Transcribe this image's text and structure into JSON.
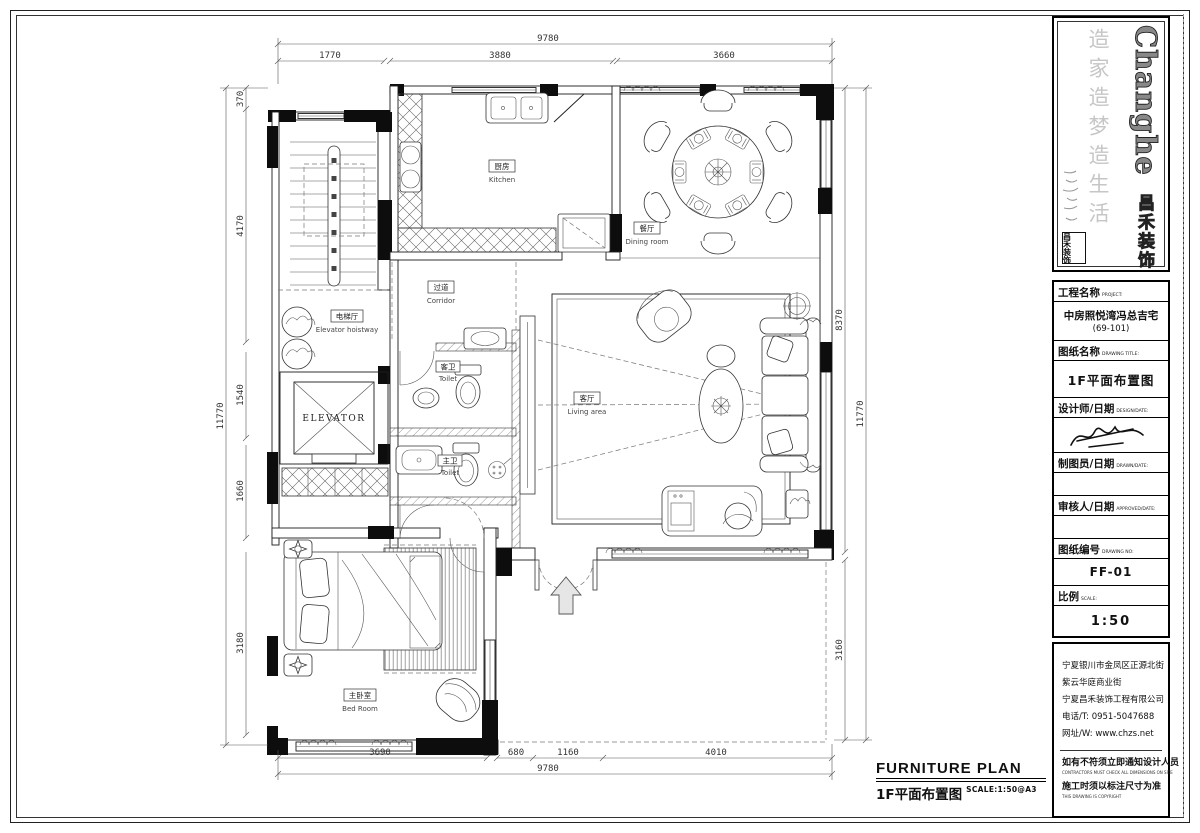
{
  "plan": {
    "rooms": {
      "kitchen": {
        "cn": "厨房",
        "en": "Kitchen"
      },
      "dining": {
        "cn": "餐厅",
        "en": "Dining room"
      },
      "corridor": {
        "cn": "过道",
        "en": "Corridor"
      },
      "elevator_hall": {
        "cn": "电梯厅",
        "en": "Elevator hoistway"
      },
      "elevator": {
        "label": "ELEVATOR"
      },
      "guest_toilet": {
        "cn": "客卫",
        "en": "Toilet"
      },
      "master_toilet": {
        "cn": "主卫",
        "en": "Toilet"
      },
      "living": {
        "cn": "客厅",
        "en": "Living area"
      },
      "bedroom": {
        "cn": "主卧室",
        "en": "Bed Room"
      }
    },
    "dims": {
      "top": {
        "overall": "9780",
        "segs": [
          "1770",
          "3880",
          "3660"
        ]
      },
      "bottom": {
        "overall": "9780",
        "segs": [
          "3690",
          "680",
          "1160",
          "4010"
        ]
      },
      "left": {
        "overall": "11770",
        "segs": [
          "370",
          "4170",
          "1540",
          "1660",
          "3180"
        ]
      },
      "right": {
        "overall": "11770",
        "segs": [
          "8370",
          "3160"
        ]
      }
    }
  },
  "footer": {
    "title_en": "FURNITURE PLAN",
    "title_cn": "1F平面布置图",
    "scale": "SCALE:1:50@A3"
  },
  "titleblock": {
    "logo": {
      "en": "Changhe",
      "cn": "昌禾装饰",
      "slogan": "造家造梦造生活",
      "seal": "昌禾装饰"
    },
    "project": {
      "label_cn": "工程名称",
      "label_en": "PROJECT:",
      "value": "中房照悦湾冯总吉宅",
      "value2": "(69-101)"
    },
    "drawing_title": {
      "label_cn": "图纸名称",
      "label_en": "DRAWING TITLE:",
      "value": "1F平面布置图"
    },
    "designer": {
      "label_cn": "设计师/日期",
      "label_en": "DESIGN/DATE:"
    },
    "drafter": {
      "label_cn": "制图员/日期",
      "label_en": "DRAWN/DATE:"
    },
    "approver": {
      "label_cn": "审核人/日期",
      "label_en": "APPROVED/DATE:"
    },
    "drawing_no": {
      "label_cn": "图纸编号",
      "label_en": "DRAWING NO:",
      "value": "FF-01"
    },
    "scale": {
      "label_cn": "比例",
      "label_en": "SCALE:",
      "value": "1:50"
    },
    "address": {
      "line1": "宁夏银川市金凤区正源北街",
      "line2": "紫云华庭商业街",
      "company": "宁夏昌禾装饰工程有限公司",
      "phone": "电话/T: 0951-5047688",
      "website": "网址/W: www.chzs.net"
    },
    "notes": {
      "n1_cn": "如有不符须立即通知设计人员",
      "n1_en": "CONTRACTORS MUST CHECK ALL DIMENSIONS ON SITE",
      "n2_cn": "施工时须以标注尺寸为准",
      "n2_en": "THIS DRAWING IS COPYRIGHT"
    }
  }
}
